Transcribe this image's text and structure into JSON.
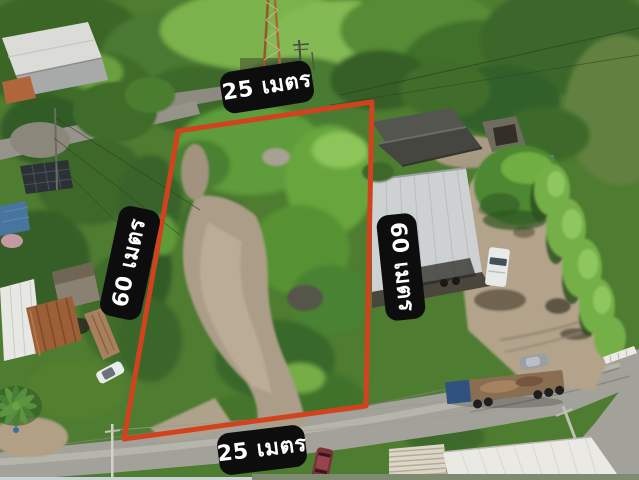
{
  "colors": {
    "plot_outline": "#d2421f",
    "label_bg": "#0d0d0d",
    "label_text": "#ffffff"
  },
  "photo": {
    "description": "Aerial drone photograph of a vacant land plot outlined in red, surrounded by houses, a warehouse yard, roads and dense trees",
    "plot_width_label_top": "25 เมตร",
    "plot_width_label_bottom": "25 เมตร",
    "plot_depth_label_left": "60 เมตร",
    "plot_depth_label_right": "60 เมตร"
  }
}
